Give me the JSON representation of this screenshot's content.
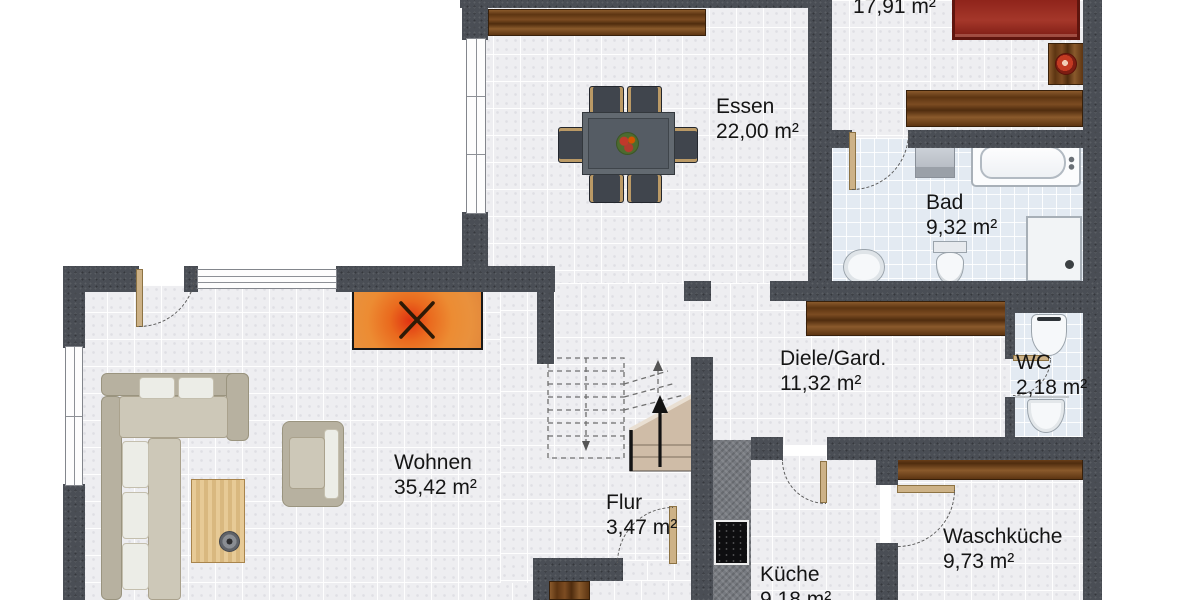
{
  "plan": {
    "type": "floor-plan",
    "rooms": [
      {
        "name": "",
        "area": "17,91 m²"
      },
      {
        "name": "Essen",
        "area": "22,00 m²"
      },
      {
        "name": "Bad",
        "area": "9,32 m²"
      },
      {
        "name": "Diele/Gard.",
        "area": "11,32 m²"
      },
      {
        "name": "WC",
        "area": "2,18 m²"
      },
      {
        "name": "Wohnen",
        "area": "35,42 m²"
      },
      {
        "name": "Flur",
        "area": "3,47 m²"
      },
      {
        "name": "Küche",
        "area": "9,18 m²"
      },
      {
        "name": "Waschküche",
        "area": "9,73 m²"
      }
    ],
    "colors": {
      "wall": "#4a4e55",
      "floor_tile": "#eeeef1",
      "bath_tile": "#e3eaf2",
      "wood": "#6b3d18",
      "fireplace": "#e8872e",
      "bed": "#9c2a22",
      "door": "#cdb287",
      "sofa": "#c6c1b1",
      "stairs": "#cfbca7"
    }
  }
}
